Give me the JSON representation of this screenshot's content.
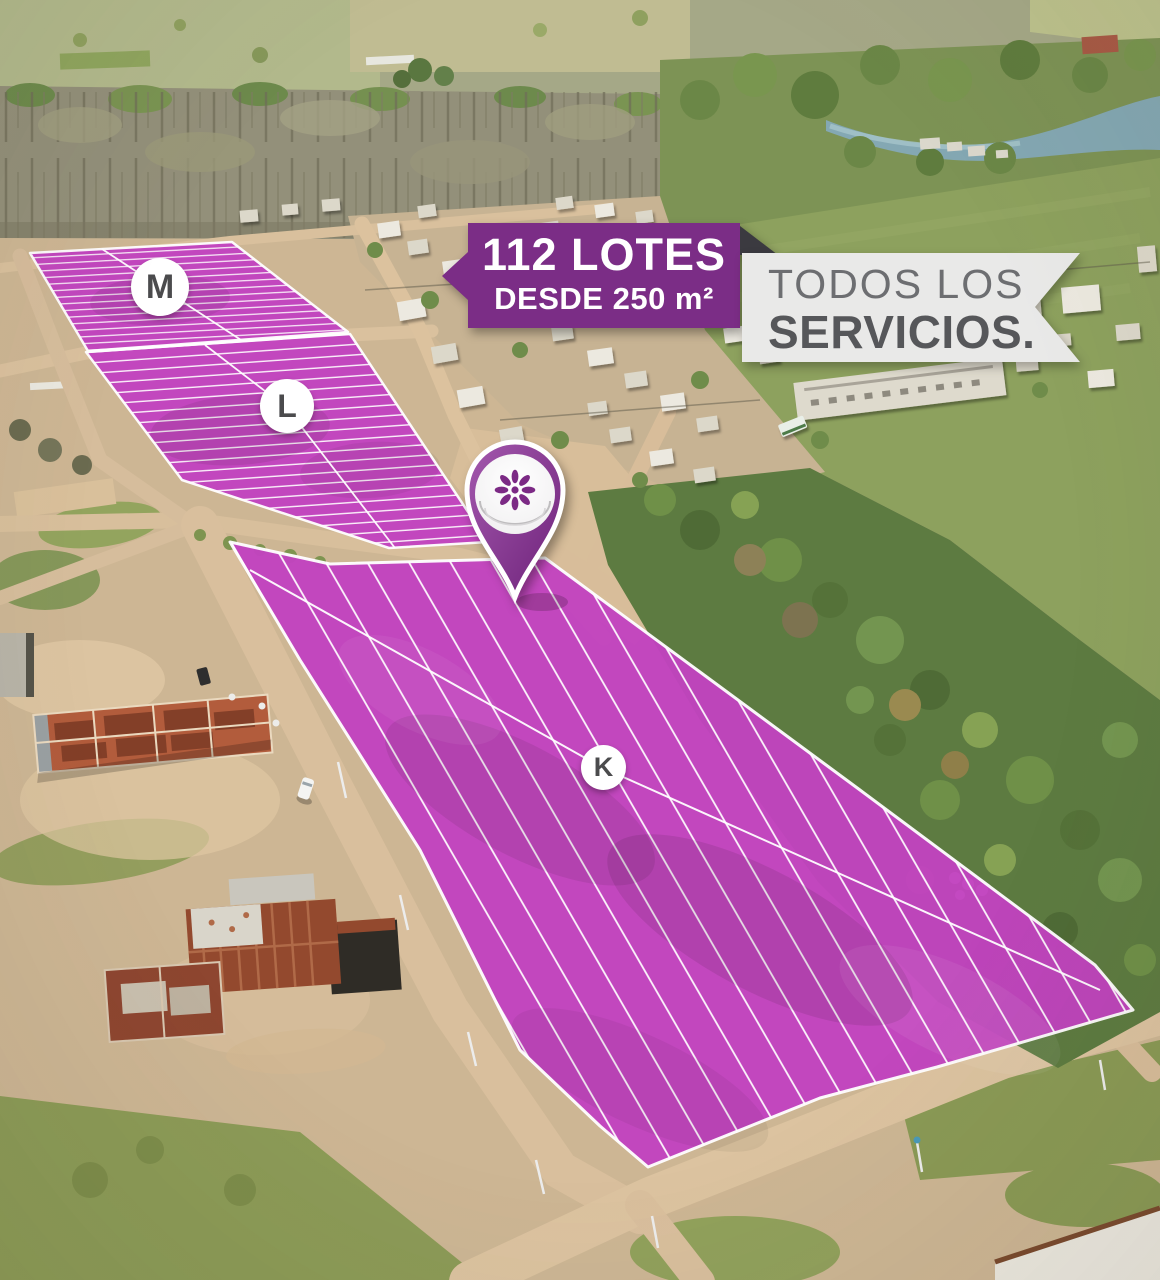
{
  "ad": {
    "lots_banner": {
      "title": "112 LOTES",
      "subtitle": "DESDE 250 m²"
    },
    "services_banner": {
      "line1": "TODOS LOS",
      "line2": "SERVICIOS."
    },
    "blocks": [
      {
        "label": "M"
      },
      {
        "label": "L"
      },
      {
        "label": "K"
      }
    ],
    "pin": {
      "icon": "petal-flower-logo"
    },
    "colors": {
      "lot_overlay": "#c243c0",
      "lot_line": "#ffffff",
      "banner_purple": "#7b2d86",
      "banner_fold": "#3b3a40",
      "banner_gray": "#e9e9e8",
      "services_top": "#6d6e71",
      "services_bottom": "#56575a",
      "pin_body": "#87368f",
      "pin_logo": "#7c2a85",
      "label_text": "#4b4b4d"
    }
  }
}
